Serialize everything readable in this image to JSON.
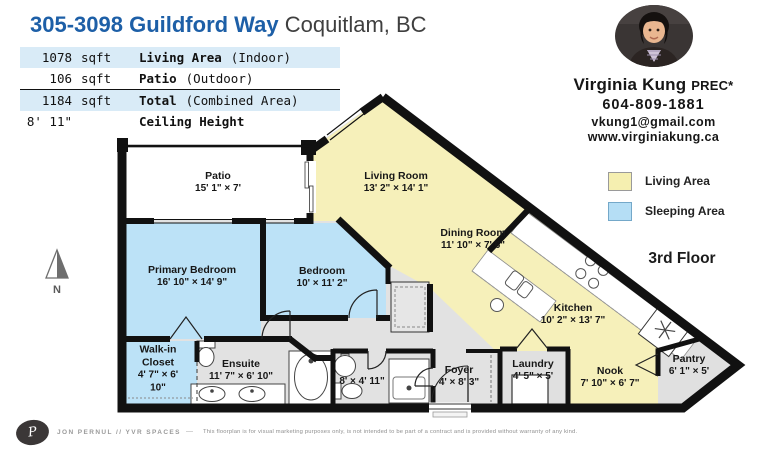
{
  "header": {
    "title_address": "305-3098 Guildford Way",
    "title_city": "Coquitlam, BC",
    "stats": [
      {
        "value": "1078",
        "unit": "sqft",
        "label": "Living Area",
        "note": "(Indoor)",
        "highlight": true
      },
      {
        "value": "106",
        "unit": "sqft",
        "label": "Patio",
        "note": "(Outdoor)",
        "highlight": false
      },
      {
        "value": "1184",
        "unit": "sqft",
        "label": "Total",
        "note": "(Combined Area)",
        "highlight": true
      },
      {
        "value": "8' 11\"",
        "unit": "",
        "label": "Ceiling Height",
        "note": "",
        "highlight": false
      }
    ]
  },
  "agent": {
    "name": "Virginia Kung",
    "designation": "PREC*",
    "phone": "604-809-1881",
    "email": "vkung1@gmail.com",
    "website": "www.virginiakung.ca",
    "photo": "agent-headshot"
  },
  "legend": {
    "items": [
      {
        "label": "Living Area",
        "color": "#f5efb0"
      },
      {
        "label": "Sleeping Area",
        "color": "#b5def5"
      }
    ]
  },
  "floor_label": "3rd Floor",
  "compass": {
    "label": "N"
  },
  "rooms": {
    "patio": {
      "name": "Patio",
      "dims": "15' 1\" × 7'"
    },
    "living": {
      "name": "Living Room",
      "dims": "13' 2\" × 14' 1\""
    },
    "dining": {
      "name": "Dining Room",
      "dims": "11' 10\" × 7' 6\""
    },
    "primary": {
      "name": "Primary Bedroom",
      "dims": "16' 10\" × 14' 9\""
    },
    "bedroom": {
      "name": "Bedroom",
      "dims": "10' × 11' 2\""
    },
    "kitchen": {
      "name": "Kitchen",
      "dims": "10' 2\" × 13' 7\""
    },
    "walkin": {
      "name": "Walk-in Closet",
      "dims": "4' 7\" × 6' 10\""
    },
    "ensuite": {
      "name": "Ensuite",
      "dims": "11' 7\" × 6' 10\""
    },
    "bath": {
      "name": "",
      "dims": "8' × 4' 11\""
    },
    "foyer": {
      "name": "Foyer",
      "dims": "4' × 8' 3\""
    },
    "laundry": {
      "name": "Laundry",
      "dims": "4' 5\" × 5'"
    },
    "nook": {
      "name": "Nook",
      "dims": "7' 10\" × 6' 7\""
    },
    "pantry": {
      "name": "Pantry",
      "dims": "6' 1\" × 5'"
    }
  },
  "colors": {
    "living_area": "#f6f0ba",
    "sleeping_area": "#bce2f7",
    "hall_floor": "#e2e2e2",
    "walls": "#111111",
    "accent_blue": "#1d5fa7",
    "stat_highlight": "#d9ebf7"
  },
  "footer": {
    "logo_monogram": "P",
    "brand": "JON PERNUL // YVR SPACES",
    "separator": "—",
    "disclaimer": "This floorplan is for visual marketing purposes only, is not intended to be part of a contract and is provided without warranty of any kind."
  }
}
